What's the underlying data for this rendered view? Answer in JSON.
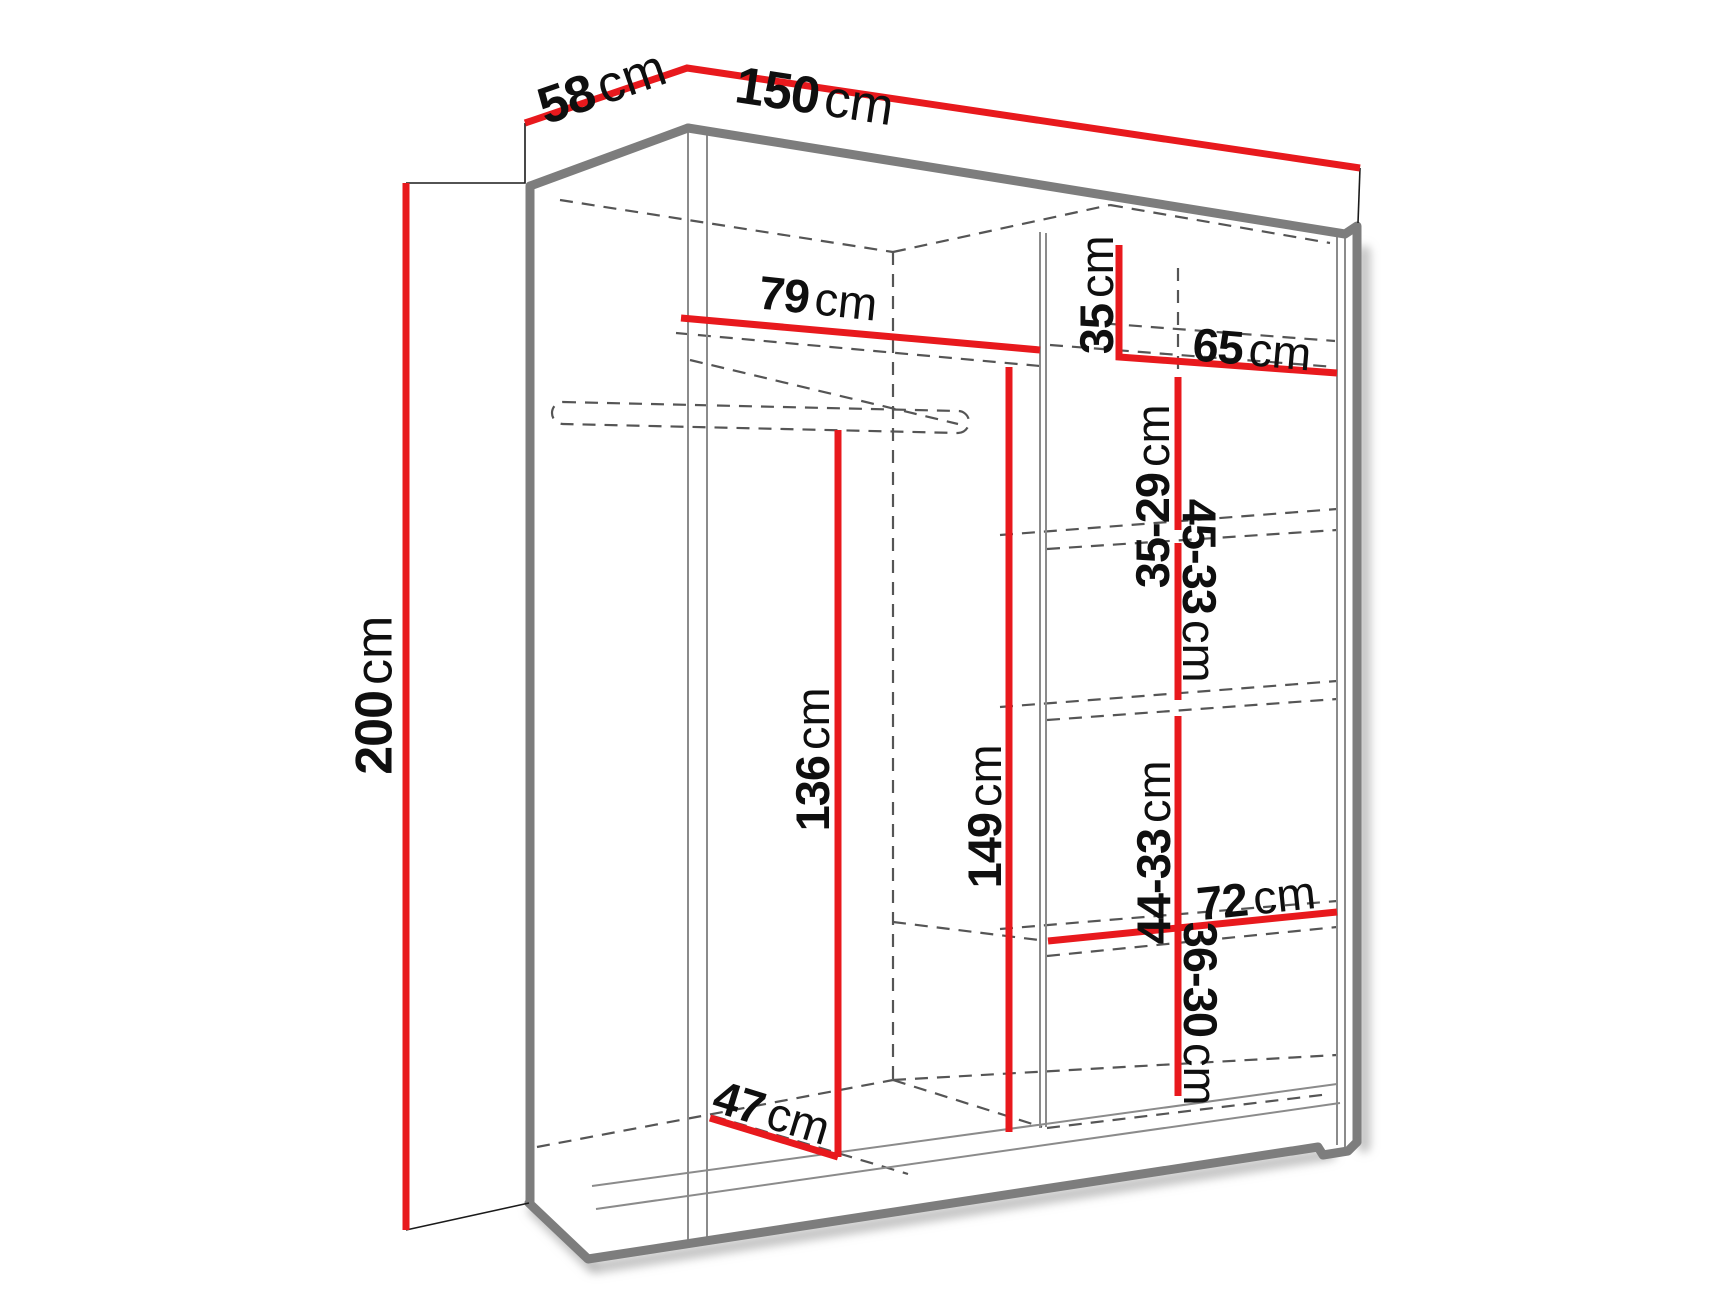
{
  "page": {
    "title": "Wardrobe dimension diagram",
    "background": "#ffffff"
  },
  "diagram": {
    "type": "furniture-dimension-diagram",
    "subject": "two-door sliding wardrobe with shelves and hanging rail, drawn in perspective",
    "units": "cm",
    "colors": {
      "dimension_line": "#e8191d",
      "cabinet_edge": "#7d7d7d",
      "hidden_edge": "#555555",
      "label_text": "#0f0f0f",
      "background": "#ffffff"
    },
    "overall": {
      "width_cm": 150,
      "depth_cm": 58,
      "height_cm": 200
    },
    "dimensions": [
      {
        "id": "depth-overall",
        "num": "58",
        "unit": "cm",
        "cx": 595,
        "cy": 88,
        "rot": -19,
        "size": 52
      },
      {
        "id": "width-overall",
        "num": "150",
        "unit": "cm",
        "cx": 822,
        "cy": 96,
        "rot": 8.5,
        "size": 52
      },
      {
        "id": "height-overall",
        "num": "200",
        "unit": "cm",
        "cx": 373,
        "cy": 688,
        "rot": -90,
        "size": 52
      },
      {
        "id": "left-shelf-width",
        "num": "79",
        "unit": "cm",
        "cx": 812,
        "cy": 297,
        "rot": 6,
        "size": 47
      },
      {
        "id": "top-right-shelf-height",
        "num": "35",
        "unit": "cm",
        "cx": 1096,
        "cy": 301,
        "rot": -90,
        "size": 47
      },
      {
        "id": "right-shelf-width",
        "num": "65",
        "unit": "cm",
        "cx": 1246,
        "cy": 348,
        "rot": 5,
        "size": 47
      },
      {
        "id": "right-gap-1",
        "num": "35-29",
        "unit": "cm",
        "cx": 1152,
        "cy": 470,
        "rot": -90,
        "size": 47
      },
      {
        "id": "right-gap-2",
        "num": "45-33",
        "unit": "cm",
        "cx": 1200,
        "cy": 617,
        "rot": 90,
        "size": 47
      },
      {
        "id": "hanging-space-height",
        "num": "136",
        "unit": "cm",
        "cx": 812,
        "cy": 753,
        "rot": -90,
        "size": 47
      },
      {
        "id": "left-inner-height",
        "num": "149",
        "unit": "cm",
        "cx": 984,
        "cy": 810,
        "rot": -90,
        "size": 47
      },
      {
        "id": "right-gap-3",
        "num": "44-33",
        "unit": "cm",
        "cx": 1153,
        "cy": 826,
        "rot": -90,
        "size": 47
      },
      {
        "id": "bottom-shelf-width",
        "num": "72",
        "unit": "cm",
        "cx": 1250,
        "cy": 898,
        "rot": -6,
        "size": 47
      },
      {
        "id": "right-gap-4",
        "num": "36-30",
        "unit": "cm",
        "cx": 1201,
        "cy": 1040,
        "rot": 90,
        "size": 47
      },
      {
        "id": "floor-depth",
        "num": "47",
        "unit": "cm",
        "cx": 766,
        "cy": 1110,
        "rot": 17,
        "size": 47
      }
    ]
  }
}
